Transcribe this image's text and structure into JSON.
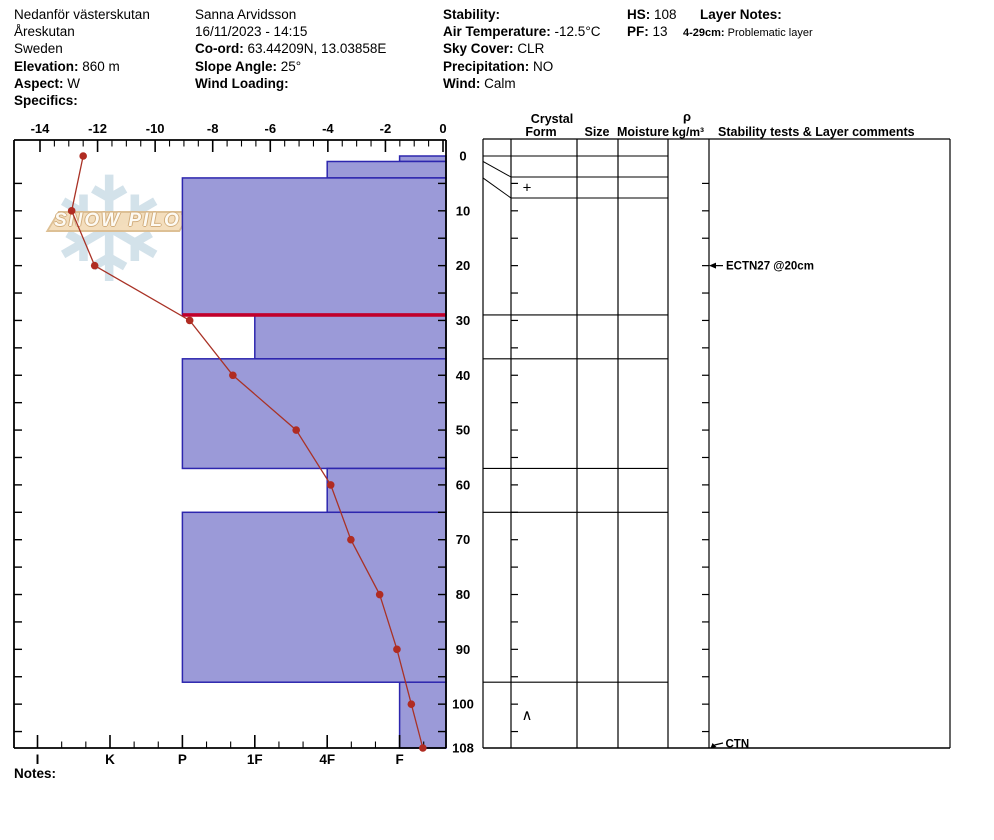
{
  "header": {
    "location": {
      "line1": "Nedanför västerskutan",
      "line2": "Åreskutan",
      "line3": "Sweden",
      "elevation_label": "Elevation:",
      "elevation": "860 m",
      "aspect_label": "Aspect:",
      "aspect": "W",
      "specifics_label": "Specifics:",
      "specifics": ""
    },
    "observer": {
      "name": "Sanna Arvidsson",
      "datetime": "16/11/2023 - 14:15",
      "coord_label": "Co-ord:",
      "coord": "63.44209N, 13.03858E",
      "slope_label": "Slope Angle:",
      "slope": "25°",
      "wind_loading_label": "Wind Loading:",
      "wind_loading": ""
    },
    "conditions": {
      "stability_label": "Stability:",
      "stability": "",
      "air_temp_label": "Air Temperature:",
      "air_temp": "-12.5°C",
      "sky_label": "Sky Cover:",
      "sky": "CLR",
      "precip_label": "Precipitation:",
      "precip": "NO",
      "wind_label": "Wind:",
      "wind": "Calm"
    },
    "summary": {
      "hs_label": "HS:",
      "hs": "108",
      "pf_label": "PF:",
      "pf": "13"
    },
    "layer_notes": {
      "title": "Layer Notes:",
      "range_label": "4-29cm:",
      "note": "Problematic layer"
    }
  },
  "table_headers": {
    "crystal": "Crystal",
    "form": "Form",
    "size": "Size",
    "moisture": "Moisture",
    "rho": "ρ",
    "rho_unit": "kg/m³",
    "comments": "Stability tests & Layer comments"
  },
  "footer": {
    "notes_label": "Notes:"
  },
  "watermark": {
    "text": "SNOW PILOT",
    "snowflake_icon": "❄"
  },
  "chart_data": {
    "type": "snow-profile",
    "title": "Snow pit profile: hardness bars + temperature curve vs depth",
    "temperature_axis": {
      "unit": "°C",
      "tick_labels": [
        -14,
        -12,
        -10,
        -8,
        -6,
        -4,
        -2,
        0
      ],
      "minor_step": 0.5,
      "range": [
        -14,
        0
      ],
      "position": "top"
    },
    "hardness_axis": {
      "categories": [
        "I",
        "K",
        "P",
        "1F",
        "4F",
        "F"
      ],
      "position": "bottom"
    },
    "depth_axis": {
      "unit": "cm",
      "tick_labels": [
        0,
        10,
        20,
        30,
        40,
        50,
        60,
        70,
        80,
        90,
        100,
        108
      ],
      "minor_step": 5,
      "max": 108,
      "position": "right"
    },
    "snow_height_cm": 108,
    "layers": [
      {
        "top": 0,
        "bottom": 1,
        "hardness": "F",
        "grain_form": ""
      },
      {
        "top": 1,
        "bottom": 4,
        "hardness": "4F",
        "grain_form": "+"
      },
      {
        "top": 4,
        "bottom": 29,
        "hardness": "P",
        "grain_form": "",
        "problematic_bottom": true
      },
      {
        "top": 29,
        "bottom": 37,
        "hardness": "1F",
        "grain_form": ""
      },
      {
        "top": 37,
        "bottom": 57,
        "hardness": "P",
        "grain_form": ""
      },
      {
        "top": 57,
        "bottom": 65,
        "hardness": "4F",
        "grain_form": ""
      },
      {
        "top": 65,
        "bottom": 96,
        "hardness": "P",
        "grain_form": ""
      },
      {
        "top": 96,
        "bottom": 108,
        "hardness": "F",
        "grain_form": "∧"
      }
    ],
    "temperature_profile": [
      {
        "depth": 0,
        "temp": -12.5
      },
      {
        "depth": 10,
        "temp": -12.9
      },
      {
        "depth": 20,
        "temp": -12.1
      },
      {
        "depth": 30,
        "temp": -8.8
      },
      {
        "depth": 40,
        "temp": -7.3
      },
      {
        "depth": 50,
        "temp": -5.1
      },
      {
        "depth": 60,
        "temp": -3.9
      },
      {
        "depth": 70,
        "temp": -3.2
      },
      {
        "depth": 80,
        "temp": -2.2
      },
      {
        "depth": 90,
        "temp": -1.6
      },
      {
        "depth": 100,
        "temp": -1.1
      },
      {
        "depth": 108,
        "temp": -0.7
      }
    ],
    "stability_tests": [
      {
        "label": "ECTN27 @20cm",
        "depth": 20,
        "arrow": "left"
      },
      {
        "label": "CTN",
        "depth": 108,
        "arrow": "down-left"
      }
    ],
    "colors": {
      "layer_fill": "#9b9ad8",
      "layer_border": "#2d26ae",
      "problem_line": "#c1002b",
      "temp_line": "#a93226",
      "temp_marker": "#b02c22",
      "grid": "#000000",
      "watermark_flake": "#c9dbe6",
      "watermark_banner": "#f4ddba"
    },
    "legend_position": "none",
    "grid": "off"
  }
}
